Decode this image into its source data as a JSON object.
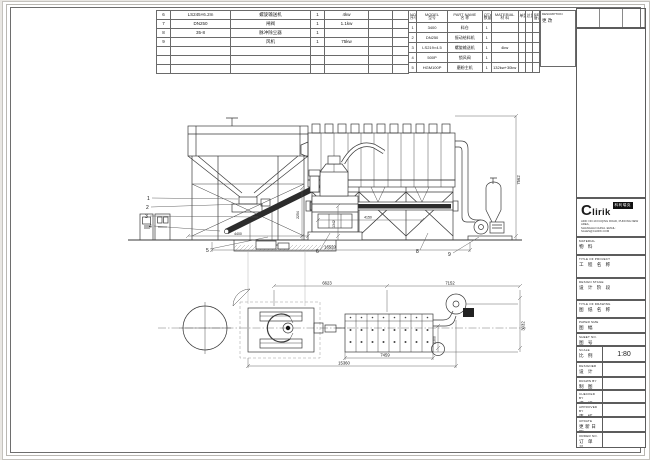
{
  "tables": {
    "left": {
      "rows": [
        {
          "no": "6",
          "model": "LS245×6.2m",
          "name": "螺旋输送机",
          "qty": "1",
          "power": "4kw"
        },
        {
          "no": "7",
          "model": "DN250",
          "name": "闸阀",
          "qty": "1",
          "power": "1.1kw"
        },
        {
          "no": "8",
          "model": "35-8",
          "name": "脉冲除尘器",
          "qty": "1",
          "power": ""
        },
        {
          "no": "9",
          "model": "",
          "name": "风机",
          "qty": "1",
          "power": "75kw"
        }
      ]
    },
    "right": {
      "headers": {
        "no_en": "NO.",
        "no_cn": "序号",
        "model_en": "MODEL",
        "model_cn": "型号",
        "name_en": "PART NAME",
        "name_cn": "名 称",
        "qty_en": "QTY",
        "qty_cn": "数量",
        "material_en": "MATERIAL",
        "material_cn": "材 料",
        "unit_weight": "单重",
        "total_weight": "总重",
        "remark_en": "REMARK",
        "remark_cn": "备注"
      },
      "rows": [
        {
          "no": "1",
          "model": "3400",
          "name": "料仓",
          "qty": "1",
          "material": ""
        },
        {
          "no": "2",
          "model": "DN250",
          "name": "振动给料机",
          "qty": "1",
          "material": ""
        },
        {
          "no": "3",
          "model": "LS219×4.5",
          "name": "螺旋输送机",
          "qty": "1",
          "material": "4kw"
        },
        {
          "no": "4",
          "model": "500P",
          "name": "锁风阀",
          "qty": "1",
          "material": ""
        },
        {
          "no": "5",
          "model": "HGM100P",
          "name": "磨粉主机",
          "qty": "1",
          "material": "132kw+30kw"
        }
      ]
    }
  },
  "description_box": {
    "title": "DESCRIPTION",
    "subtitle": "更 改"
  },
  "logo": {
    "brand": "Clirik",
    "brand_cn": "科利瑞克",
    "address_line1": "ADD: NO.19 FUQING ROAD, PUDONG NEW AREA,",
    "address_line2": "SHANGHAI CHINA.  EMAIL: SALES@CLIRIK.COM"
  },
  "title_block": {
    "material": {
      "en": "MATERIAL",
      "cn": "物 料"
    },
    "project": {
      "en": "TITLE OF PROJECT",
      "cn": "工 程 名 称"
    },
    "design_stage": {
      "en": "DESIGN STAGE",
      "cn": "设 计 阶 段"
    },
    "drawing_title": {
      "en": "TITLE OF DRAWING",
      "cn": "图 纸 名 称"
    },
    "paper_size": {
      "en": "PAPER SIZE",
      "cn": "图 幅"
    },
    "sheet_no": {
      "en": "SHEET NO.",
      "cn": "图 号"
    },
    "scale": {
      "en": "SCALE",
      "cn": "比 例",
      "value": "1:80"
    },
    "designer": {
      "en": "DESIGNER",
      "cn": "设 计"
    },
    "drawn_by": {
      "en": "DRAWN BY",
      "cn": "制 图"
    },
    "checked_by": {
      "en": "CHECKED BY",
      "cn": "校 核"
    },
    "approved_by": {
      "en": "APPROVED BY",
      "cn": "审 核"
    },
    "update": {
      "en": "UPDATE",
      "cn": "更新日期"
    },
    "order_no": {
      "en": "ORDER NO.",
      "cn": "订 单 号"
    }
  },
  "drawing": {
    "dims": {
      "height_right": "7562",
      "bottom_total": "16520",
      "screw_length": "4150",
      "hopper_width": "4400",
      "v1342": "1342",
      "v2254": "2254",
      "plan_top_left": "6623",
      "plan_top_right": "7152",
      "plan_bottom_inner": "7459",
      "plan_bottom_outer": "15360",
      "plan_right": "3032",
      "plan_duct": "2300"
    },
    "callouts": {
      "c1": "1",
      "c2": "2",
      "c3": "3",
      "c4": "4",
      "c5": "5",
      "c6": "6",
      "c8": "8",
      "c9": "9"
    }
  },
  "colors": {
    "line": "#3a3a3a",
    "sheet": "#ffffff",
    "background": "#e9e7e3",
    "ink": "#111111"
  }
}
